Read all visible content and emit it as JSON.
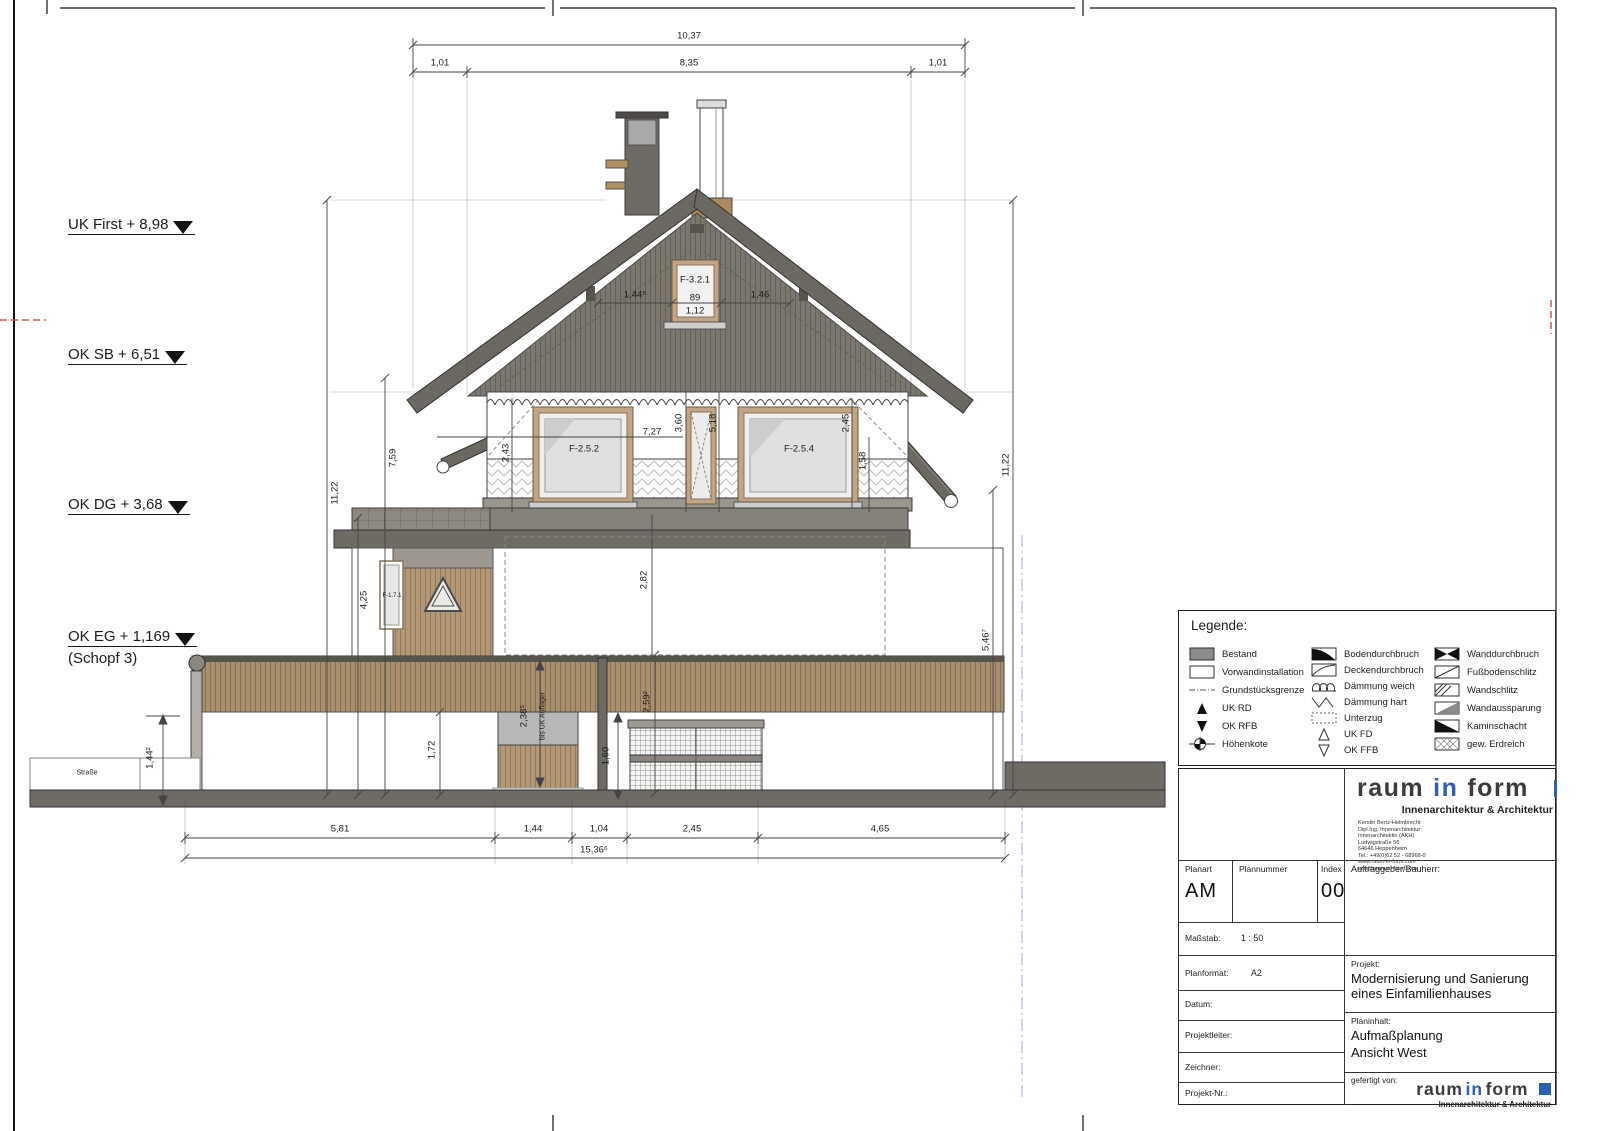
{
  "levels": {
    "uk_first": "UK First + 8,98",
    "ok_sb": "OK SB + 6,51",
    "ok_dg": "OK DG + 3,68",
    "ok_eg": "OK EG + 1,169",
    "ok_eg2": "(Schopf 3)"
  },
  "dims": {
    "top_total": "10,37",
    "top_left": "1,01",
    "top_mid": "8,35",
    "top_right": "1,01",
    "left_total": "11,22",
    "left_mid": "7,59",
    "left_low": "4,25",
    "right_total": "11,22",
    "right_low": "5,46⁷",
    "gable_left": "1,44⁵",
    "gable_right": "1,46",
    "gable_win_w": "89",
    "gable_win_w2": "1,12",
    "dg_a": "2,43",
    "dg_b": "7,27",
    "dg_c": "3,60",
    "dg_d": "5,18",
    "dg_e": "2,45",
    "dg_f": "1,58",
    "eg_a": "2,82",
    "eg_b": "2,38⁵",
    "eg_b2": "bis UK Auflager",
    "eg_c": "2,59²",
    "eg_d": "1,60",
    "eg_e": "1,72",
    "eg_f": "1,44²",
    "bot_1": "5,81",
    "bot_2": "1,44",
    "bot_3": "1,04",
    "bot_4": "2,45",
    "bot_5": "4,65",
    "bot_total": "15,36⁶"
  },
  "windows": {
    "gable": "F-3.2.1",
    "dg_left": "F-2.5.2",
    "dg_right": "F-2.5.4",
    "eg_left": "F-1.7.1"
  },
  "street": "Straße",
  "legend": {
    "title": "Legende:",
    "col1": [
      "Bestand",
      "Vorwandinstallation",
      "Grundstücksgrenze",
      "UK RD",
      "OK RFB",
      "Höhenkote"
    ],
    "col2": [
      "Bodendurchbruch",
      "Deckendurchbruch",
      "Dämmung weich",
      "Dämmung hart",
      "Unterzug",
      "UK FD",
      "OK FFB"
    ],
    "col3": [
      "Wanddurchbruch",
      "Fußbodenschlitz",
      "Wandschlitz",
      "Wandaussparung",
      "Kaminschacht",
      "gew. Erdreich"
    ]
  },
  "titleblock": {
    "logo": {
      "w1": "raum",
      "w2": "in",
      "w3": "form",
      "tagline": "Innenarchitektur & Architektur"
    },
    "address": [
      "Kerstin Bertz-Helmbrecht",
      "Dipl.Ing. Innenarchitektur",
      "Innenarchitektin (AKH)",
      "Ludwigstraße 56",
      "64646 Heppenheim",
      "Tel.: +49(0)62 52 - 68968-0",
      "www.raum-in-form.com",
      "info@raum-in-form.com"
    ],
    "planart_label": "Planart",
    "plannummer_label": "Plannummer",
    "index_label": "Index",
    "planart_value": "AM",
    "index_value": "00",
    "auftraggeber_label": "Auftraggeber/Bauherr:",
    "massstab_label": "Maßstab:",
    "massstab_value": "1 : 50",
    "planformat_label": "Planformat:",
    "planformat_value": "A2",
    "datum_label": "Datum:",
    "projekt_label": "Projekt:",
    "projekt_value": "Modernisierung und Sanierung eines Einfamilienhauses",
    "projektleiter_label": "Projektleiter:",
    "planinhalt_label": "Planinhalt:",
    "planinhalt_1": "Aufmaßplanung",
    "planinhalt_2": "Ansicht West",
    "zeichner_label": "Zeichner:",
    "projektnr_label": "Projekt-Nr.:",
    "gefertigt_label": "gefertigt von:",
    "colors": {
      "logo_blue": "#2b62ad"
    }
  }
}
